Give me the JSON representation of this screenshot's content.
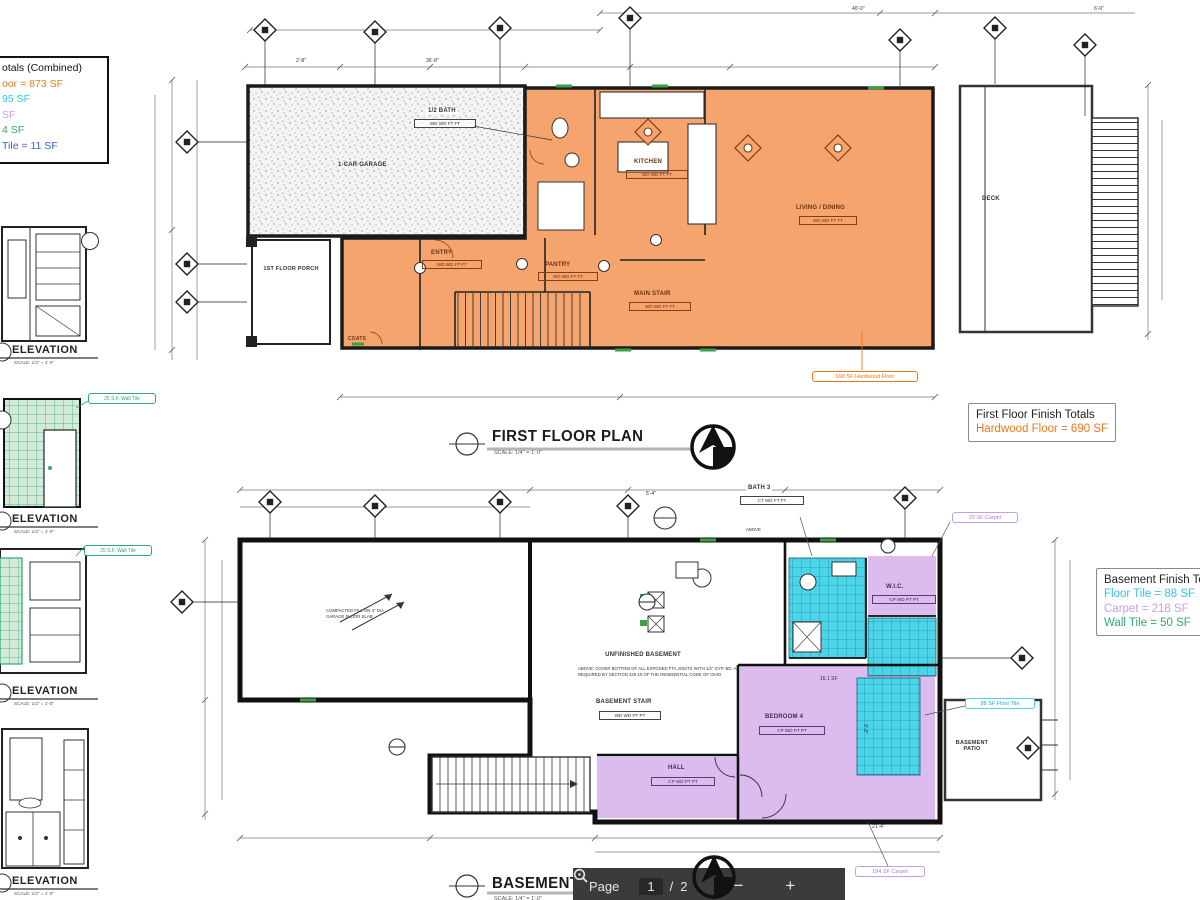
{
  "toolbar": {
    "page_label": "Page",
    "current_page": "1",
    "page_separator": "/",
    "total_pages": "2",
    "zoom_out_label": "−",
    "zoom_in_label": "+"
  },
  "combined_totals": {
    "title": "otals (Combined)",
    "hardwood": "oor = 873 SF",
    "floor_tile": "95 SF",
    "carpet": "SF",
    "wall_tile": "4 SF",
    "other_tile": "Tile = 11 SF",
    "colors": {
      "hardwood": "#e8781e",
      "floor_tile": "#2bc7e8",
      "carpet": "#c9a0e0",
      "wall_tile": "#2ea878",
      "other_tile": "#3d5fd6"
    }
  },
  "first_floor": {
    "title": "FIRST FLOOR PLAN",
    "scale": "SCALE: 1/4\" = 1'-0\"",
    "totals_title": "First Floor Finish Totals",
    "totals_hardwood": "Hardwood Floor = 690 SF",
    "area_label": "690 SF Hardwood Floor",
    "rooms": {
      "garage": "1-CAR GARAGE",
      "half_bath": "1/2 BATH",
      "kitchen": "KITCHEN",
      "living": "LIVING / DINING",
      "entry": "ENTRY",
      "pantry": "PANTRY",
      "main_stair": "MAIN STAIR",
      "coats": "COATS",
      "porch": "1ST FLOOR PORCH",
      "deck": "DECK"
    },
    "codes": {
      "half_bath": "WD WD FT FT",
      "kitchen": "WD WD FT FT",
      "living": "WD WD FT FT",
      "entry": "WD WD FT FT",
      "pantry": "WD WD FT FT",
      "main_stair": "WD WD FT FT"
    }
  },
  "basement": {
    "title": "BASEMENT PLAN",
    "scale": "SCALE: 1/4\" = 1'-0\"",
    "totals_title": "Basement Finish Totals",
    "totals_floor_tile": "Floor Tile = 88 SF",
    "totals_carpet": "Carpet = 218 SF",
    "totals_wall_tile": "Wall Tile = 50 SF",
    "labels": {
      "carpet_small": "20 SF Carpet",
      "floor_tile": "88 SF Floor Tile",
      "carpet_large": "194 SF Carpet"
    },
    "rooms": {
      "bath3": "BATH 3",
      "above": "ABOVE",
      "wic": "W.I.C.",
      "unfinished": "UNFINISHED BASEMENT",
      "stair": "BASEMENT STAIR",
      "bedroom4": "BEDROOM 4",
      "hall": "HALL",
      "patio": "BASEMENT PATIO"
    },
    "codes": {
      "bath3": "CT WD FT FT",
      "wic": "CP WD PT PT",
      "stair": "WD WD PT PT",
      "bedroom4": "CP WD PT PT",
      "hall": "CP WD PT PT"
    },
    "notes": {
      "joists": "ABOVE: COVER BOTTOM OF ALL EXPOSED FTA JOISTS WITH 1/2\" GYP. BD. AS REQUIRED BY SECTION 320.10 OF THE RESIDENTIAL CODE OF OHIO",
      "slab": "COMPACTED FILL ON 4\" DIA GARAGE FLOOR SLAB"
    }
  },
  "elevations": {
    "label": "ELEVATION",
    "scale": "SCALE: 1/2\" = 1'-0\"",
    "wall_tile": "25 S.F. Wall Tile"
  },
  "dims": {
    "d1": "36'-8\"",
    "d2": "21'-4\"",
    "d3": "9'-2\"",
    "d4": "16.1 SF",
    "d5": "40'-0\"",
    "d6": "6'-0\"",
    "d7": "2'-8\"",
    "d8": "5'-4\""
  },
  "colors": {
    "hardwood_fill": "#f4a46c",
    "tile_fill": "#4cd4e8",
    "carpet_fill": "#dcbcee",
    "wall_tile_green": "#2ea878"
  }
}
